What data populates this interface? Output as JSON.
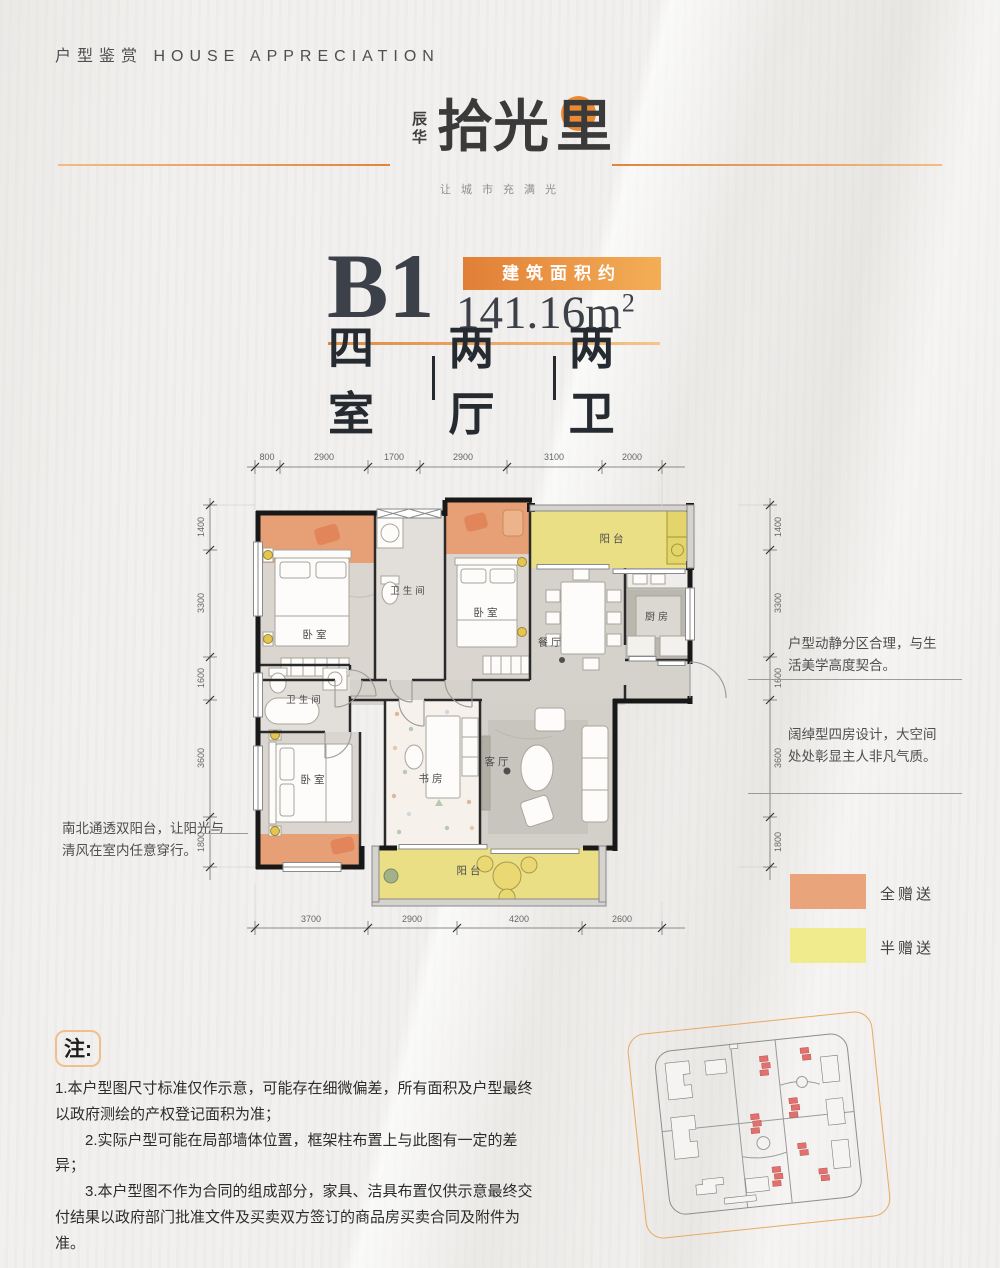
{
  "page": {
    "title": "户型鉴赏 HOUSE APPRECIATION"
  },
  "logo": {
    "brand_side": "辰华",
    "brand_main_a": "拾光",
    "brand_main_b": "里",
    "slogan": "让城市充满光",
    "accent_color": "#ec8a33"
  },
  "unit": {
    "name": "B1",
    "area_badge": "建筑面积约",
    "area_value": "141.16m",
    "area_sup": "2",
    "layout": [
      "四室",
      "两厅",
      "两卫"
    ]
  },
  "floorplan": {
    "dims_top": [
      "800",
      "2900",
      "1700",
      "2900",
      "3100",
      "2000"
    ],
    "dims_left": [
      "1400",
      "3300",
      "1600",
      "3600",
      "1800"
    ],
    "dims_right": [
      "1400",
      "3300",
      "1600",
      "3600",
      "1800"
    ],
    "dims_bottom": [
      "3700",
      "2900",
      "4200",
      "2600"
    ],
    "rooms": [
      {
        "label": "卧室"
      },
      {
        "label": "卫生间"
      },
      {
        "label": "卧室"
      },
      {
        "label": "阳台"
      },
      {
        "label": "厨房"
      },
      {
        "label": "餐厅"
      },
      {
        "label": "卫生间"
      },
      {
        "label": "卧室"
      },
      {
        "label": "书房"
      },
      {
        "label": "客厅"
      },
      {
        "label": "阳台"
      }
    ]
  },
  "annotations": {
    "left": "南北通透双阳台，让阳光与清风在室内任意穿行。",
    "right_top": "户型动静分区合理，与生活美学高度契合。",
    "right_bottom": "阔绰型四房设计，大空间处处彰显主人非凡气质。"
  },
  "legend": [
    {
      "label": "全赠送",
      "color": "#e9a47c"
    },
    {
      "label": "半赠送",
      "color": "#f0ec8e"
    }
  ],
  "notes": {
    "tag": "注:",
    "items": [
      "1.本户型图尺寸标准仅作示意，可能存在细微偏差，所有面积及户型最终以政府测绘的产权登记面积为准；",
      "　　2.实际户型可能在局部墙体位置，框架柱布置上与此图有一定的差异；",
      "　　3.本户型图不作为合同的组成部分，家具、洁具布置仅供示意最终交付结果以政府部门批准文件及买卖双方签订的商品房买卖合同及附件为准。"
    ]
  }
}
